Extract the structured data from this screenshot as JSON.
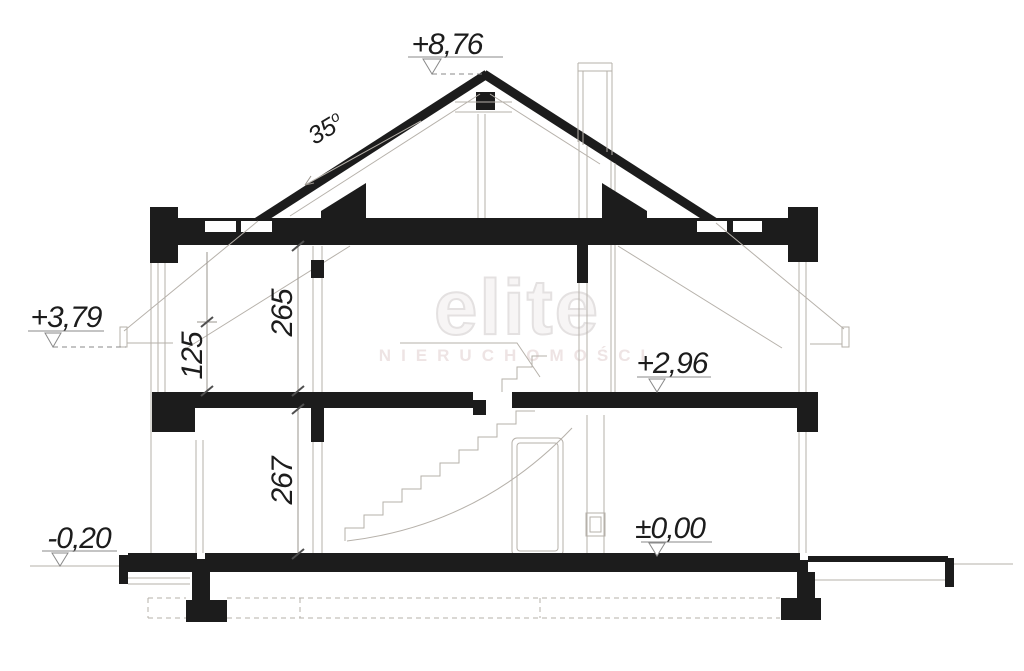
{
  "watermark": {
    "brand": "elite",
    "subtitle": "NIERUCHOMOŚCI"
  },
  "levels": {
    "ridge": "+8,76",
    "eaves": "+3,79",
    "first_floor": "+2,96",
    "ground_floor": "±0,00",
    "terrain": "-0,20"
  },
  "dimensions": {
    "attic_room_height": "265",
    "knee_wall_height": "125",
    "ground_floor_height": "267"
  },
  "roof": {
    "angle_value": "35",
    "angle_unit": "o"
  },
  "colors": {
    "ink": "#1c1c1c",
    "thin_line": "#b6b1aa",
    "dimension_line": "#9a958e",
    "tick": "#4f4f4f",
    "watermark_outline": "#e4e1e1",
    "watermark_subtitle": "#eee4e4"
  }
}
